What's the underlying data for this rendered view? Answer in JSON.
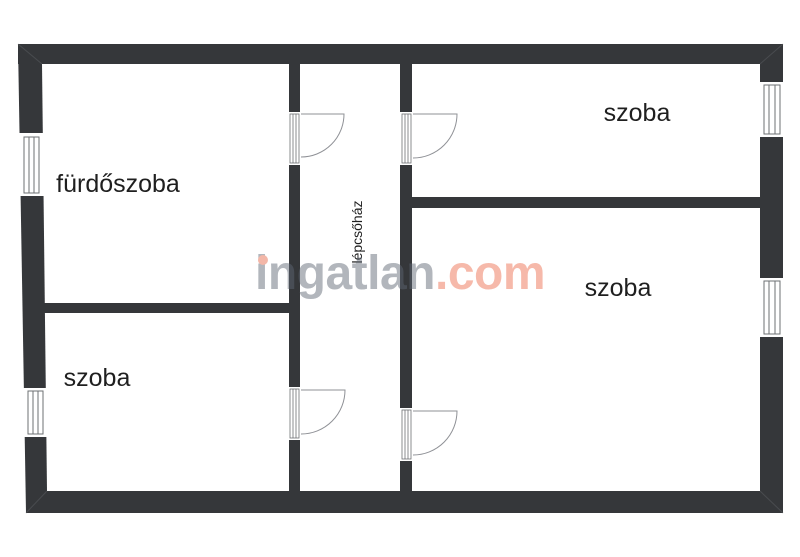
{
  "plan": {
    "rooms": [
      {
        "id": "furdoszoba",
        "label": "fürdőszoba"
      },
      {
        "id": "szoba-bottom-left",
        "label": "szoba"
      },
      {
        "id": "szoba-top-right",
        "label": "szoba"
      },
      {
        "id": "szoba-bottom-right",
        "label": "szoba"
      },
      {
        "id": "lepcsohaz",
        "label": "lépcsőház"
      }
    ]
  },
  "watermark": {
    "name": "ingatlan",
    "tld": ".com"
  },
  "colors": {
    "background": "#ffffff",
    "wall": "#35373a",
    "room_label": "#1f1f1f",
    "door_stroke": "#8f9196",
    "window_stroke": "#6e7073",
    "watermark_gray": "rgba(95,102,115,0.48)",
    "watermark_salmon": "rgba(234,100,66,0.45)",
    "watermark_dot": "#f3b7a8"
  }
}
